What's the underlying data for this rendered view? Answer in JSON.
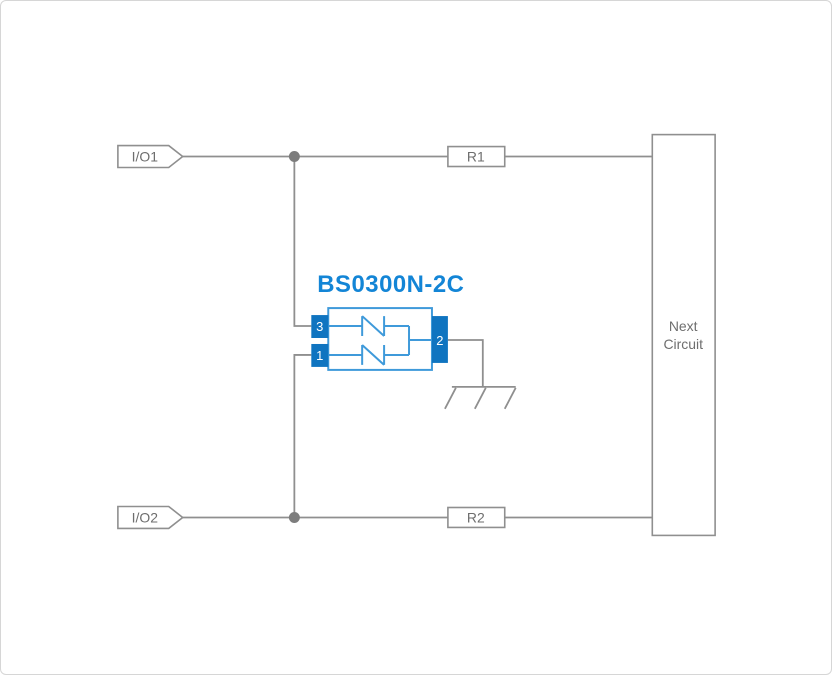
{
  "page": {
    "background": "#ffffff",
    "border_color": "#d6d6d6"
  },
  "diagram": {
    "title": "BS0300N-2C",
    "io_tags": [
      {
        "label": "I/O1"
      },
      {
        "label": "I/O2"
      }
    ],
    "resistors": [
      {
        "label": "R1"
      },
      {
        "label": "R2"
      }
    ],
    "next_circuit": {
      "line1": "Next",
      "line2": "Circuit"
    },
    "component": {
      "name": "BS0300N-2C",
      "pin_top_left": "3",
      "pin_bottom_left": "1",
      "pin_right": "2"
    },
    "icons": {
      "junction": "junction-dot",
      "ground": "chassis-ground-icon",
      "tvs": "bidirectional-tvs-diode-icon"
    },
    "colors": {
      "title_blue": "#1385d6",
      "pin_fill_blue": "#0f74c0",
      "component_stroke_blue": "#3f9ada",
      "wire_gray": "#8f8f8f",
      "label_gray": "#6e6e6e",
      "junction_gray": "#7d7d7d"
    }
  }
}
